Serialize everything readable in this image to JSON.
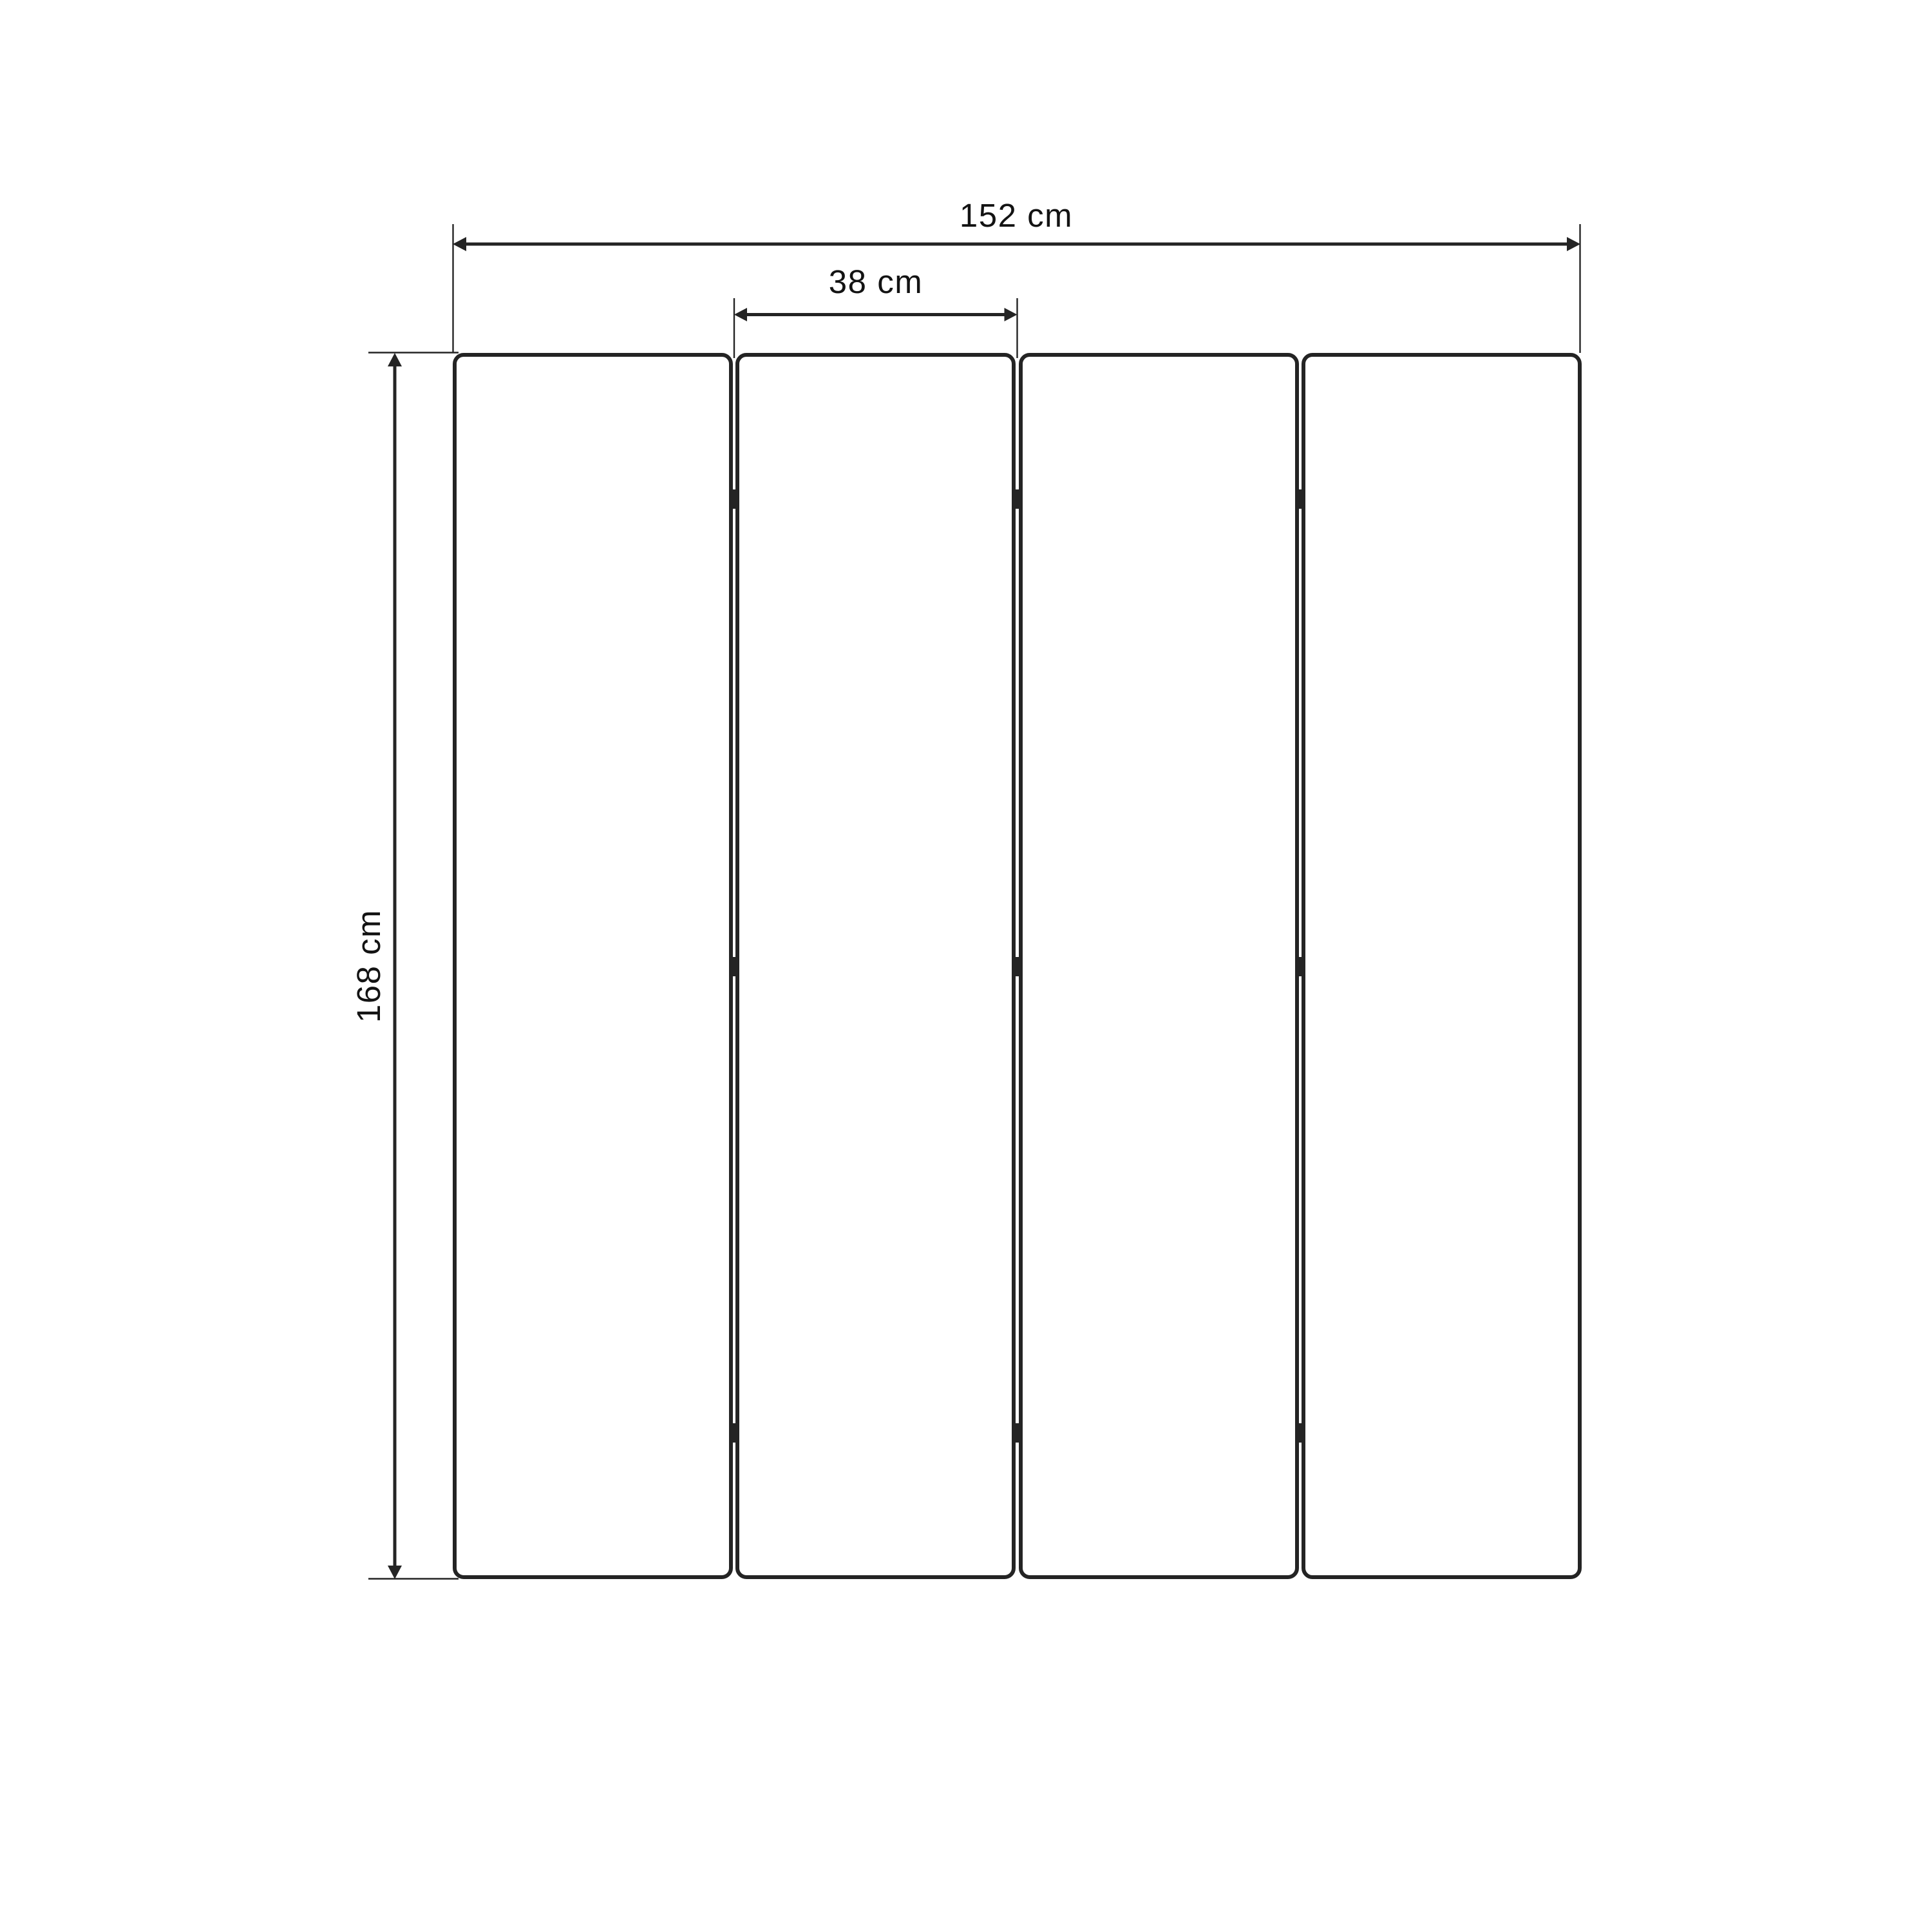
{
  "diagram": {
    "kind": "furniture-dimension-drawing",
    "object": "four-panel-folding-screen",
    "panels": {
      "count": 4,
      "junctions": 3,
      "hinge_marks_per_junction": 3
    },
    "dimensions": {
      "total_width": "152 cm",
      "panel_width": "38 cm",
      "height": "168 cm"
    },
    "colors": {
      "background": "#ffffff",
      "line": "#242424",
      "text": "#131313"
    }
  }
}
